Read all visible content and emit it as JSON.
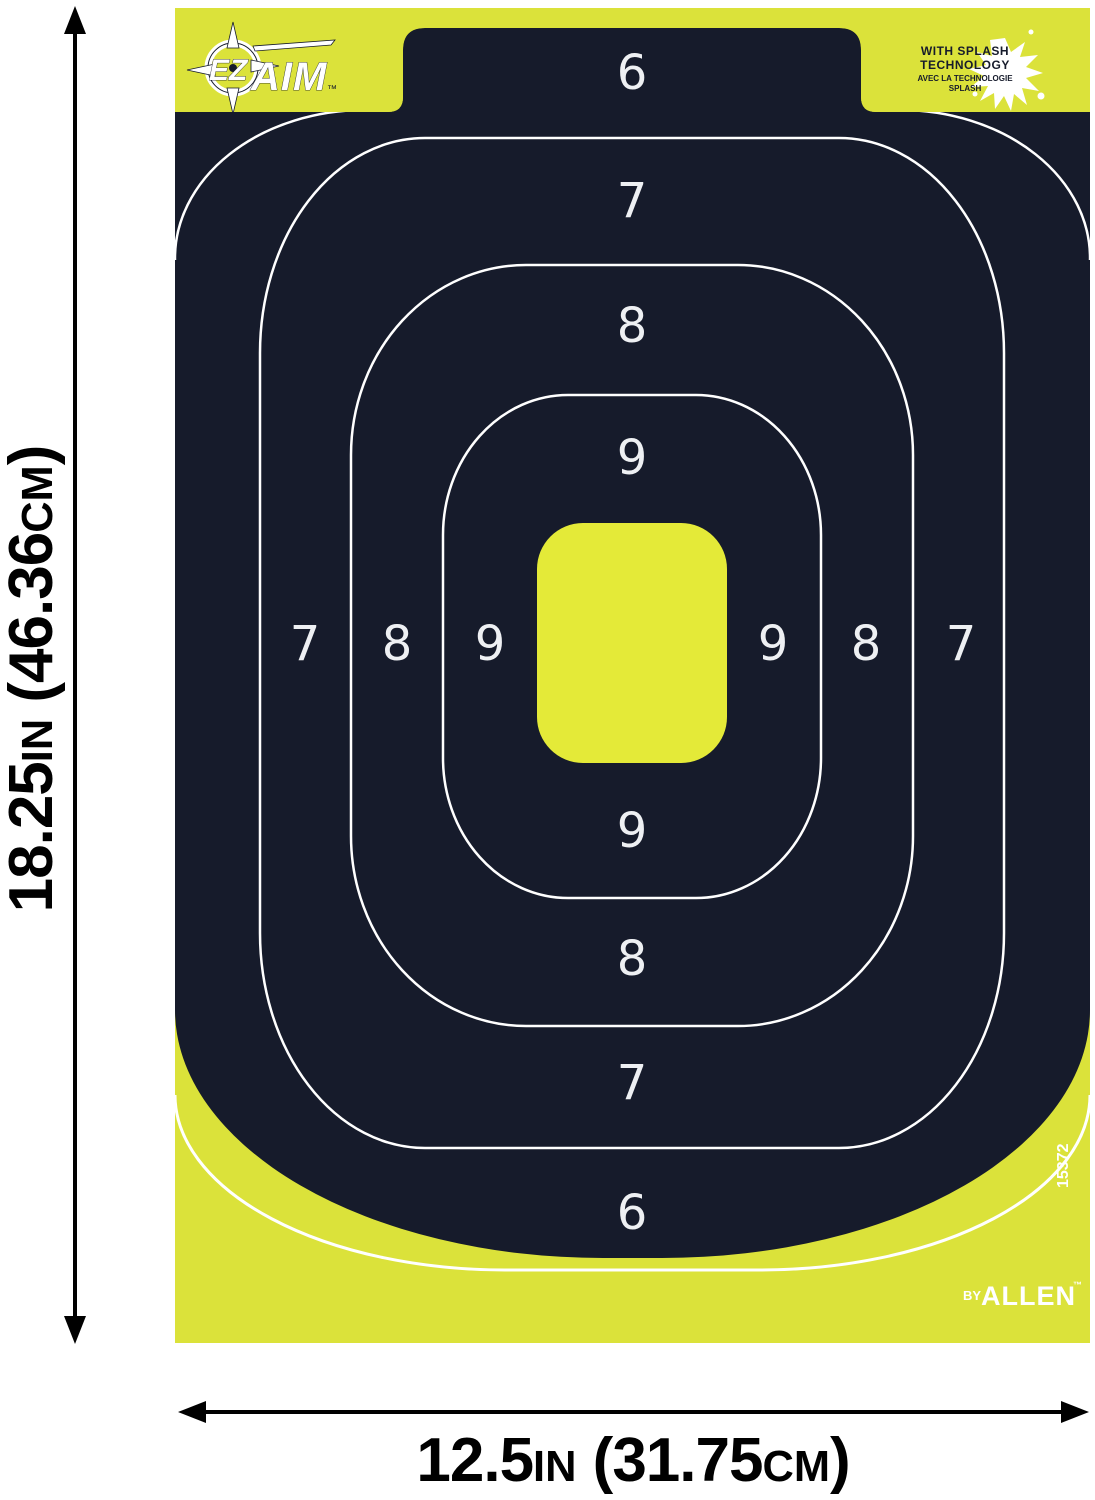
{
  "colors": {
    "page_bg": "#ffffff",
    "target_yellow": "#dbe23a",
    "bullseye_yellow": "#e4ea38",
    "target_dark": "#161b2b",
    "ring_line": "#ffffff",
    "number_color": "#eef0f3",
    "dimension_color": "#000000"
  },
  "dimensions": {
    "height": {
      "value": "18.25",
      "unit": "IN",
      "paren_value": " (46.36",
      "paren_unit": "CM",
      "close": ")"
    },
    "width": {
      "value": "12.5",
      "unit": "IN",
      "paren_value": " (31.75",
      "paren_unit": "CM",
      "close": ")"
    }
  },
  "branding": {
    "logo": {
      "ez": "EZ",
      "aim": "AIM",
      "tm": "™"
    },
    "splash_badge": {
      "line1": "WITH SPLASH",
      "line2": "TECHNOLOGY",
      "line3": "AVEC LA TECHNOLOGIE",
      "line4": "SPLASH"
    },
    "byline": {
      "by": "BY",
      "name": "ALLEN",
      "tm": "™"
    },
    "sku": "15372"
  },
  "rings": {
    "top": [
      "6",
      "7",
      "8",
      "9"
    ],
    "bottom": [
      "9",
      "8",
      "7",
      "6"
    ],
    "left": [
      "7",
      "8",
      "9"
    ],
    "right": [
      "9",
      "8",
      "7"
    ]
  }
}
